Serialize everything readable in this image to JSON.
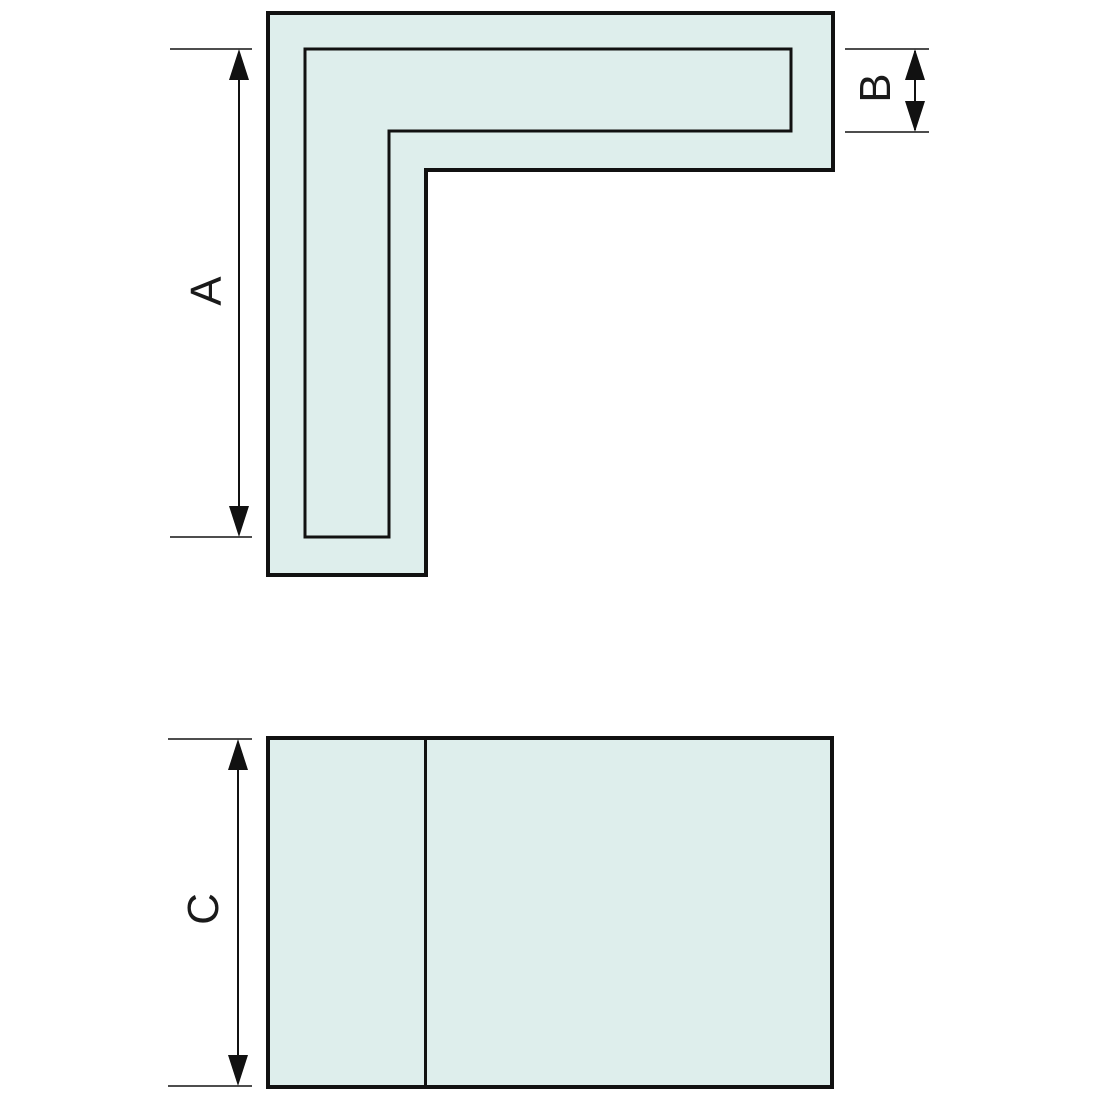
{
  "drawing": {
    "type": "technical-dimension-drawing",
    "description": "L-shaped corner profile shown in front view (top) and side view (bottom) with dimension callouts",
    "views": {
      "front_view": {
        "name": "corner-profile-front-view",
        "dimensions": {
          "a": {
            "label": "A",
            "measures": "leg length of profile (inner outline vertical extent)"
          },
          "b": {
            "label": "B",
            "measures": "face width of profile (inner outline height at right end)"
          }
        }
      },
      "side_view": {
        "name": "profile-side-view",
        "dimensions": {
          "c": {
            "label": "C",
            "measures": "height of side panel"
          }
        }
      }
    }
  },
  "colors": {
    "fill": "#deeeec",
    "outline": "#111111",
    "dimension_line": "#111111",
    "extension_line": "#4d4d4d",
    "label_text": "#1a1a1a",
    "background": "#ffffff"
  }
}
